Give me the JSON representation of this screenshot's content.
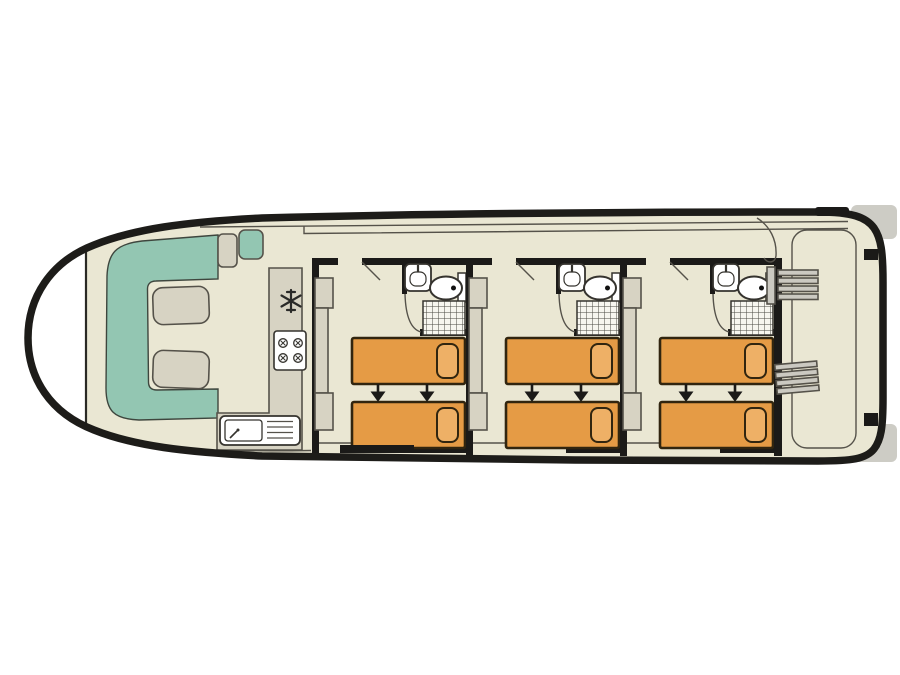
{
  "meta": {
    "title": "Houseboat lower-deck floor plan",
    "diagram_type": "boat floor plan, top-down view",
    "text_on_image": "none"
  },
  "colors": {
    "background": "#ffffff",
    "hull_outline": "#1d1c19",
    "floor": "#eae7d3",
    "wall": "#1b1a18",
    "lounge_seating": "#93c6b2",
    "furniture": "#d7d3c3",
    "bed": "#e59b45",
    "pillow": "#eeb066",
    "fixture_white": "#ffffff",
    "stairs": "#cbc9c1",
    "exterior_deck": "#ffffff",
    "platform_gray": "#cdccc5"
  },
  "layout": {
    "bow": {
      "position": "left",
      "features": [
        "pointed hull",
        "windshield line"
      ]
    },
    "saloon": {
      "seating": "U-shaped lounge sofa (teal)",
      "tables": 2,
      "helm_seats": 2
    },
    "galley": {
      "appliances": [
        "fridge-freezer (snowflake icon)",
        "4-burner stove",
        "sink with drainer"
      ]
    },
    "cabins": {
      "count": 3,
      "per_cabin": {
        "single_beds": 2,
        "bed_arrows": 2,
        "wardrobe_units": 3,
        "ensuite_fixtures": [
          "washbasin",
          "toilet",
          "shower"
        ]
      }
    },
    "stern": {
      "position": "right",
      "staircases": 2,
      "deck": "aft deck with rounded walkway outline"
    }
  }
}
